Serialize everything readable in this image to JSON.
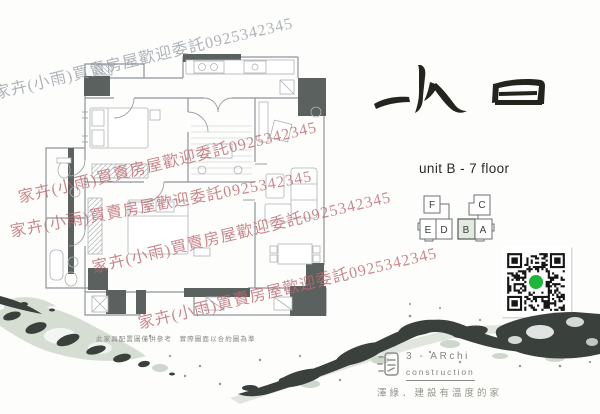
{
  "page": {
    "background": "#fdfdfb"
  },
  "watermark": {
    "text": "家卉(小雨)買賣房屋歡迎委託0925342345",
    "phone": "0925342345",
    "pink_color": "#bd6b72",
    "gray_color": "#9ba1ab"
  },
  "title": {
    "logo_text": "水日",
    "unit_line": "unit B - 7 floor"
  },
  "key_plan": {
    "units": [
      "F",
      "C",
      "E",
      "D",
      "B",
      "A"
    ],
    "highlighted_unit": "B",
    "highlight_color": "#e3eae0"
  },
  "qr_code": {
    "center_dot_color": "#1eb53a"
  },
  "plan": {
    "disclaimer": "此家具配置圖僅供參考　實際圖面以合約圖為準",
    "column_color": "#5a615e"
  },
  "brand": {
    "name_line1": "3 - ARchi",
    "name_line2": "construction",
    "tagline": "澤綠．建設有溫度的家"
  }
}
